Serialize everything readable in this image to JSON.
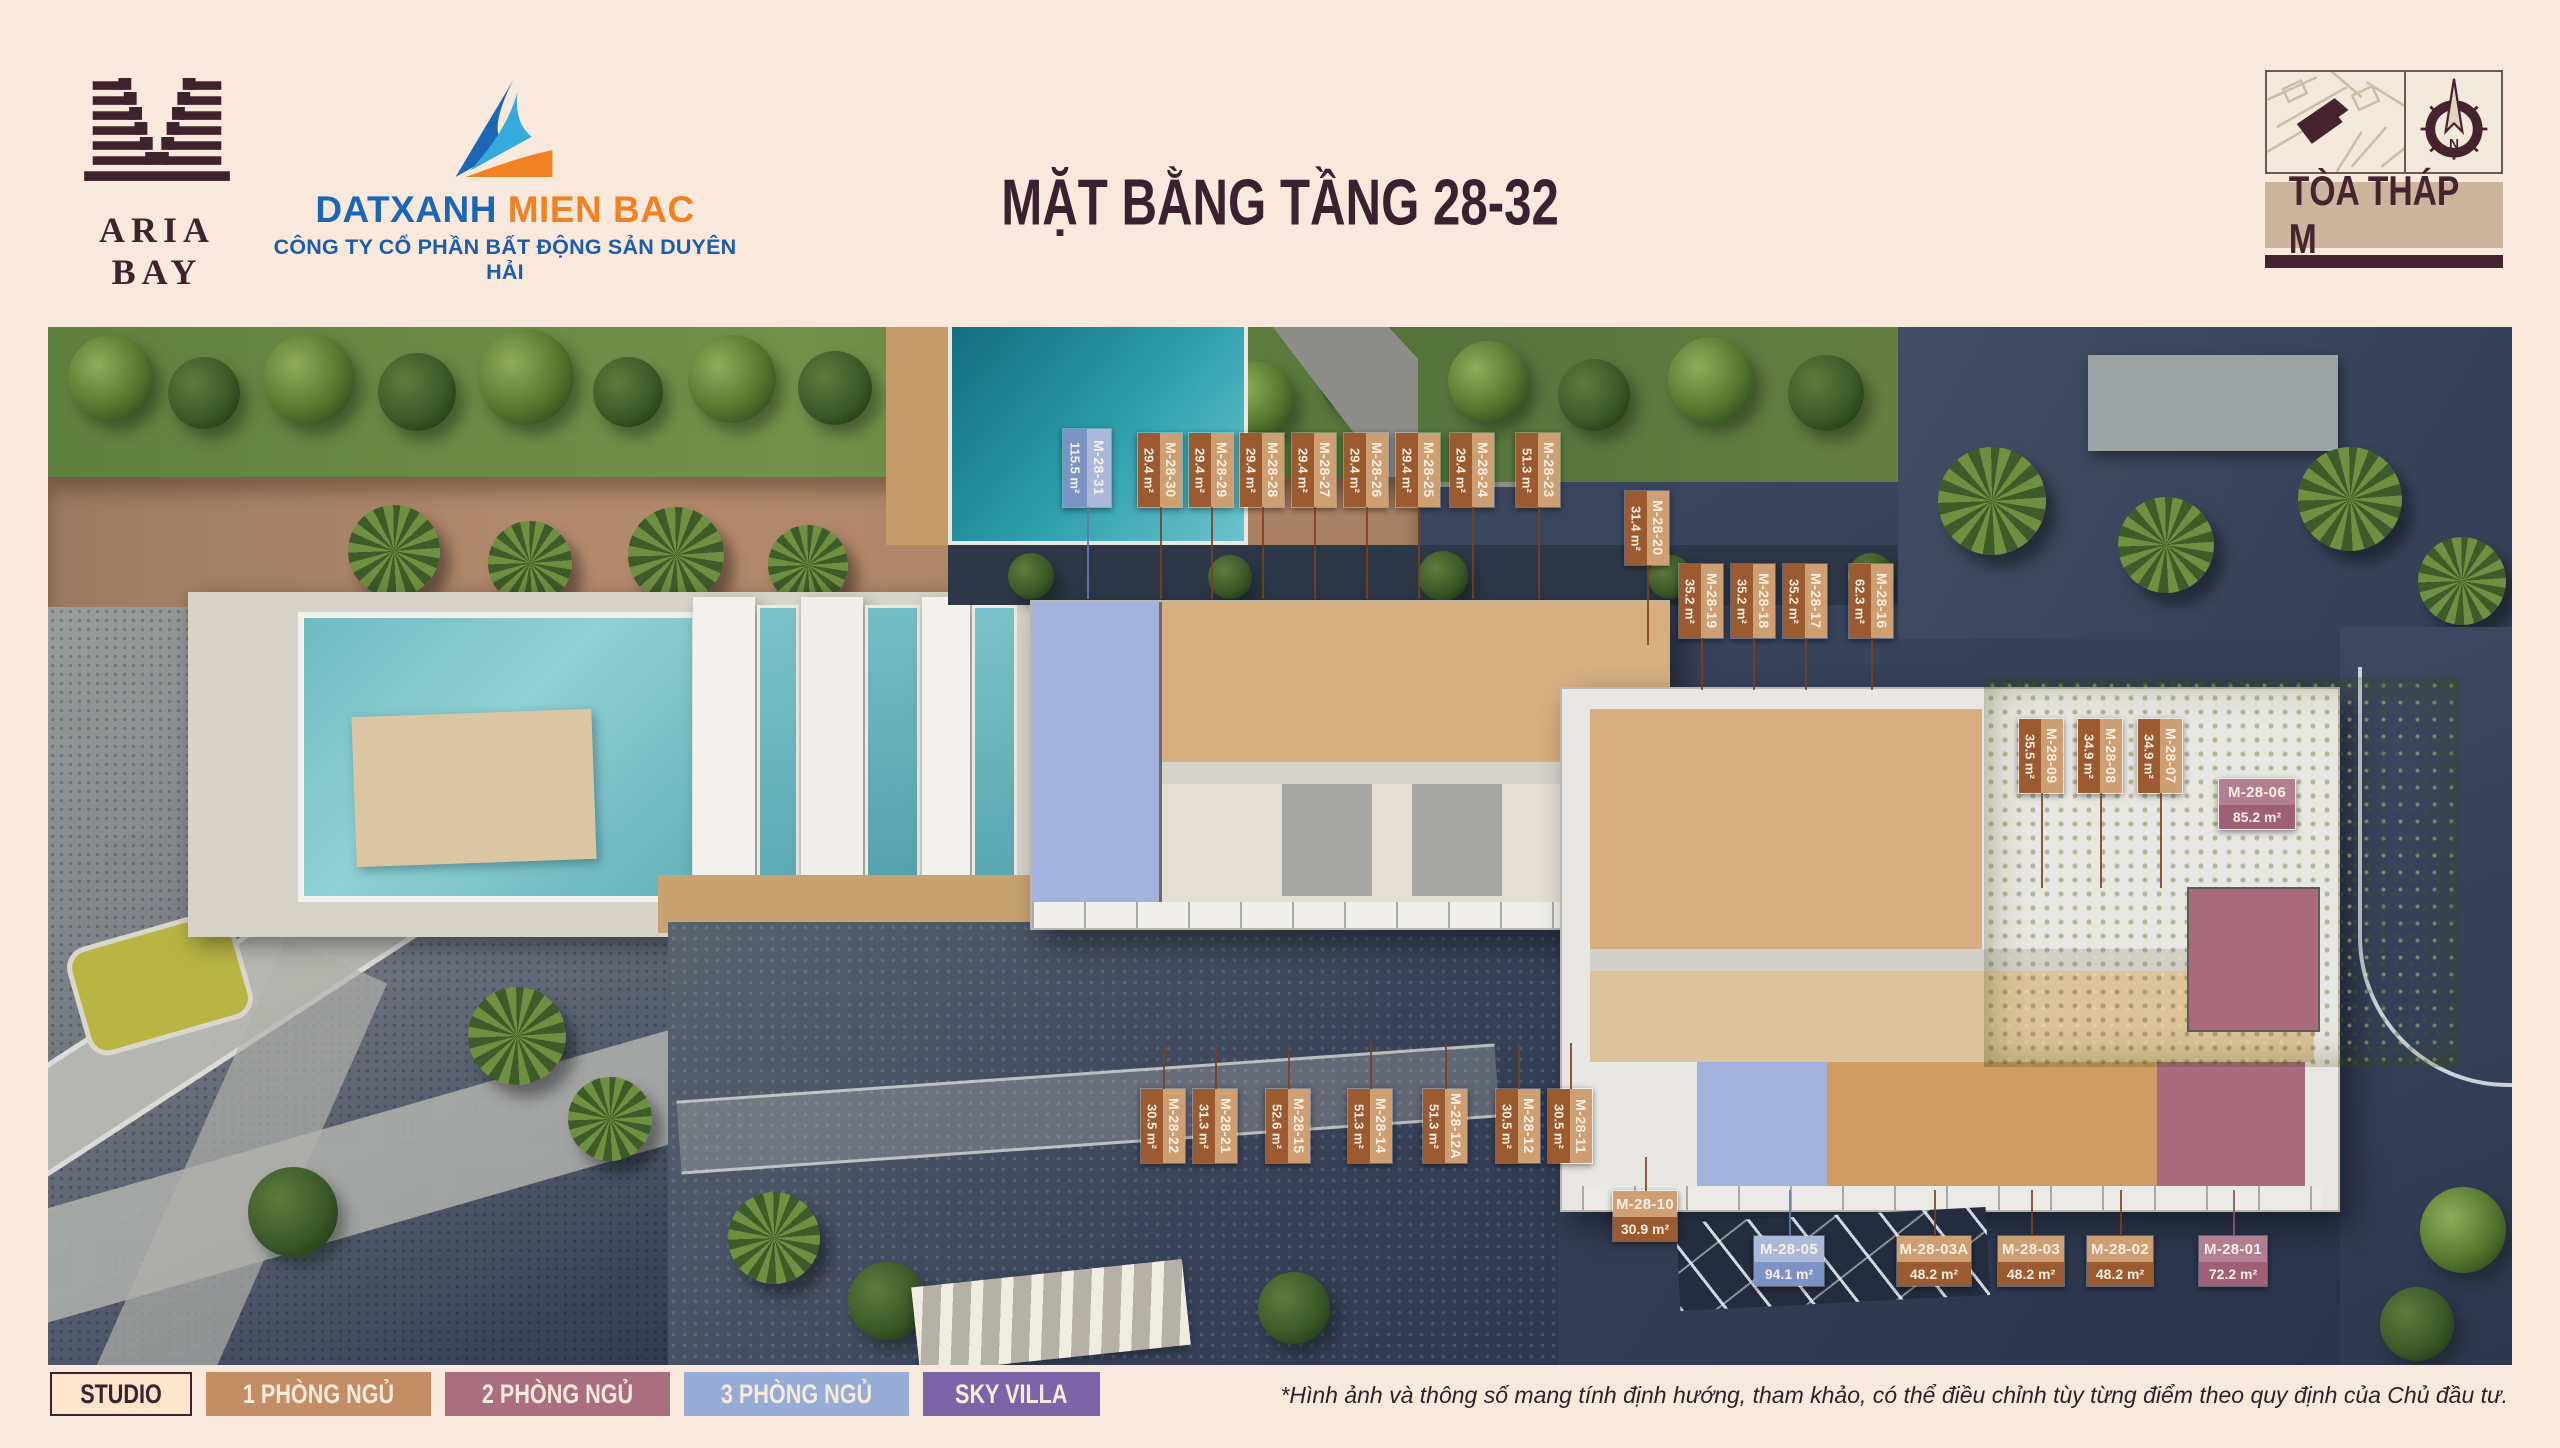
{
  "page": {
    "background": "#f9e9dc",
    "accent_maroon": "#40222e"
  },
  "header": {
    "brand": {
      "name": "ARIA BAY"
    },
    "agency": {
      "name_part1": "DATXANH",
      "name_part2": "MIEN BAC",
      "subtitle": "CÔNG TY CỔ PHẦN BẤT ĐỘNG SẢN DUYÊN HẢI",
      "colors": {
        "blue": "#1c67b5",
        "light_blue": "#36a9dd",
        "orange": "#f08224"
      }
    },
    "title": "MẶT BẰNG TẦNG 28-32",
    "tower": {
      "label": "TÒA THÁP M",
      "compass_letter": "N"
    }
  },
  "floorplan": {
    "floors_range": "28-32",
    "label_colors": {
      "brown_dark": "#9c5a31",
      "brown_light": "#cf9f74",
      "blue_dark": "#7e93c5",
      "blue_light": "#aab9da",
      "mauve_dark": "#9d6077",
      "mauve_light": "#b27e92"
    },
    "units": [
      {
        "code": "M-28-31",
        "area": "115.5 m²",
        "scheme": "blue"
      },
      {
        "code": "M-28-30",
        "area": "29.4 m²",
        "scheme": "brown"
      },
      {
        "code": "M-28-29",
        "area": "29.4 m²",
        "scheme": "brown"
      },
      {
        "code": "M-28-28",
        "area": "29.4 m²",
        "scheme": "brown"
      },
      {
        "code": "M-28-27",
        "area": "29.4 m²",
        "scheme": "brown"
      },
      {
        "code": "M-28-26",
        "area": "29.4 m²",
        "scheme": "brown"
      },
      {
        "code": "M-28-25",
        "area": "29.4 m²",
        "scheme": "brown"
      },
      {
        "code": "M-28-24",
        "area": "29.4 m²",
        "scheme": "brown"
      },
      {
        "code": "M-28-23",
        "area": "51.3 m²",
        "scheme": "brown"
      },
      {
        "code": "M-28-20",
        "area": "31.4 m²",
        "scheme": "brown"
      },
      {
        "code": "M-28-19",
        "area": "35.2 m²",
        "scheme": "brown"
      },
      {
        "code": "M-28-18",
        "area": "35.2 m²",
        "scheme": "brown"
      },
      {
        "code": "M-28-17",
        "area": "35.2 m²",
        "scheme": "brown"
      },
      {
        "code": "M-28-16",
        "area": "62.3 m²",
        "scheme": "brown"
      },
      {
        "code": "M-28-09",
        "area": "35.5 m²",
        "scheme": "brown"
      },
      {
        "code": "M-28-08",
        "area": "34.9 m²",
        "scheme": "brown"
      },
      {
        "code": "M-28-07",
        "area": "34.9 m²",
        "scheme": "brown"
      },
      {
        "code": "M-28-06",
        "area": "85.2 m²",
        "scheme": "mauve"
      },
      {
        "code": "M-28-22",
        "area": "30.5 m²",
        "scheme": "brown"
      },
      {
        "code": "M-28-21",
        "area": "31.3 m²",
        "scheme": "brown"
      },
      {
        "code": "M-28-15",
        "area": "52.6 m²",
        "scheme": "brown"
      },
      {
        "code": "M-28-14",
        "area": "51.3 m²",
        "scheme": "brown"
      },
      {
        "code": "M-28-12A",
        "area": "51.3 m²",
        "scheme": "brown"
      },
      {
        "code": "M-28-12",
        "area": "30.5 m²",
        "scheme": "brown"
      },
      {
        "code": "M-28-11",
        "area": "30.5 m²",
        "scheme": "brown"
      },
      {
        "code": "M-28-10",
        "area": "30.9 m²",
        "scheme": "brown"
      },
      {
        "code": "M-28-05",
        "area": "94.1 m²",
        "scheme": "blue"
      },
      {
        "code": "M-28-03A",
        "area": "48.2 m²",
        "scheme": "brown"
      },
      {
        "code": "M-28-03",
        "area": "48.2 m²",
        "scheme": "brown"
      },
      {
        "code": "M-28-02",
        "area": "48.2 m²",
        "scheme": "brown"
      },
      {
        "code": "M-28-01",
        "area": "72.2 m²",
        "scheme": "mauve"
      }
    ]
  },
  "legend": {
    "items": [
      {
        "label": "STUDIO",
        "bg": "#fce4cd",
        "text_color": "#3c2231"
      },
      {
        "label": "1 PHÒNG NGỦ",
        "bg": "#c38e66",
        "text_color": "#f6ead9"
      },
      {
        "label": "2 PHÒNG NGỦ",
        "bg": "#a96e80",
        "text_color": "#f6ead9"
      },
      {
        "label": "3 PHÒNG NGỦ",
        "bg": "#97abd7",
        "text_color": "#f6ead9"
      },
      {
        "label": "SKY VILLA",
        "bg": "#7b64a8",
        "text_color": "#f6ead9"
      }
    ]
  },
  "footer": {
    "disclaimer": "*Hình ảnh và thông số mang tính định hướng, tham khảo, có thể điều chỉnh tùy từng điểm theo quy định của Chủ đầu tư."
  }
}
